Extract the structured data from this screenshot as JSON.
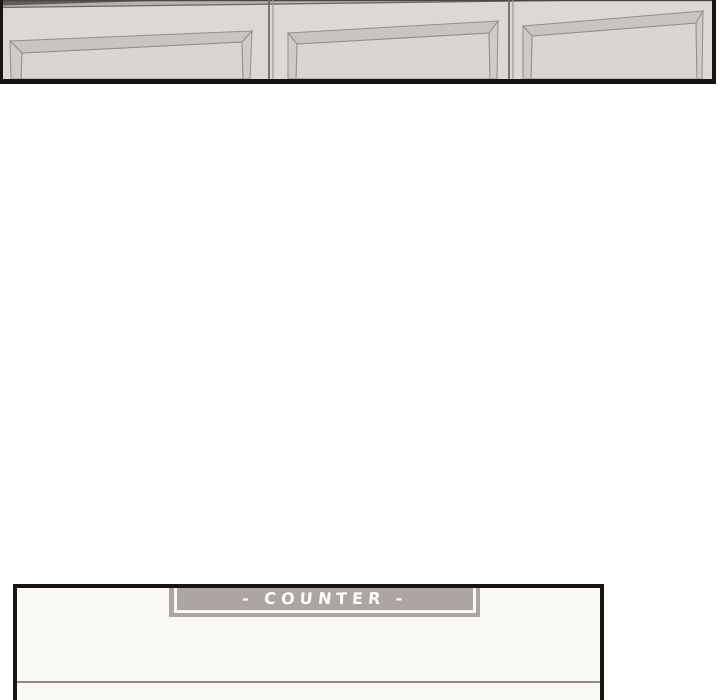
{
  "page": {
    "background": "#ffffff"
  },
  "top_panel": {
    "door_count": 3,
    "colors": {
      "door_face": "#dcd8d5",
      "bevel_top": "#c8c4c1",
      "bevel_side": "#cfcbc8",
      "recessed_face": "#d9d5d2",
      "outline": "#918d8a",
      "shelf_strip": "#b6b2af",
      "shelf_dark": "#605c59",
      "panel_border": "#171412"
    }
  },
  "bottom_panel": {
    "interior_color": "#faf8f5",
    "border_color": "#171412",
    "edge_line_color": "#8d8987",
    "counter_sign": {
      "label": "- COUNTER -",
      "background": "#ada5a2",
      "frame_color": "#f8f6f3",
      "text_color": "#fefdfb"
    }
  }
}
